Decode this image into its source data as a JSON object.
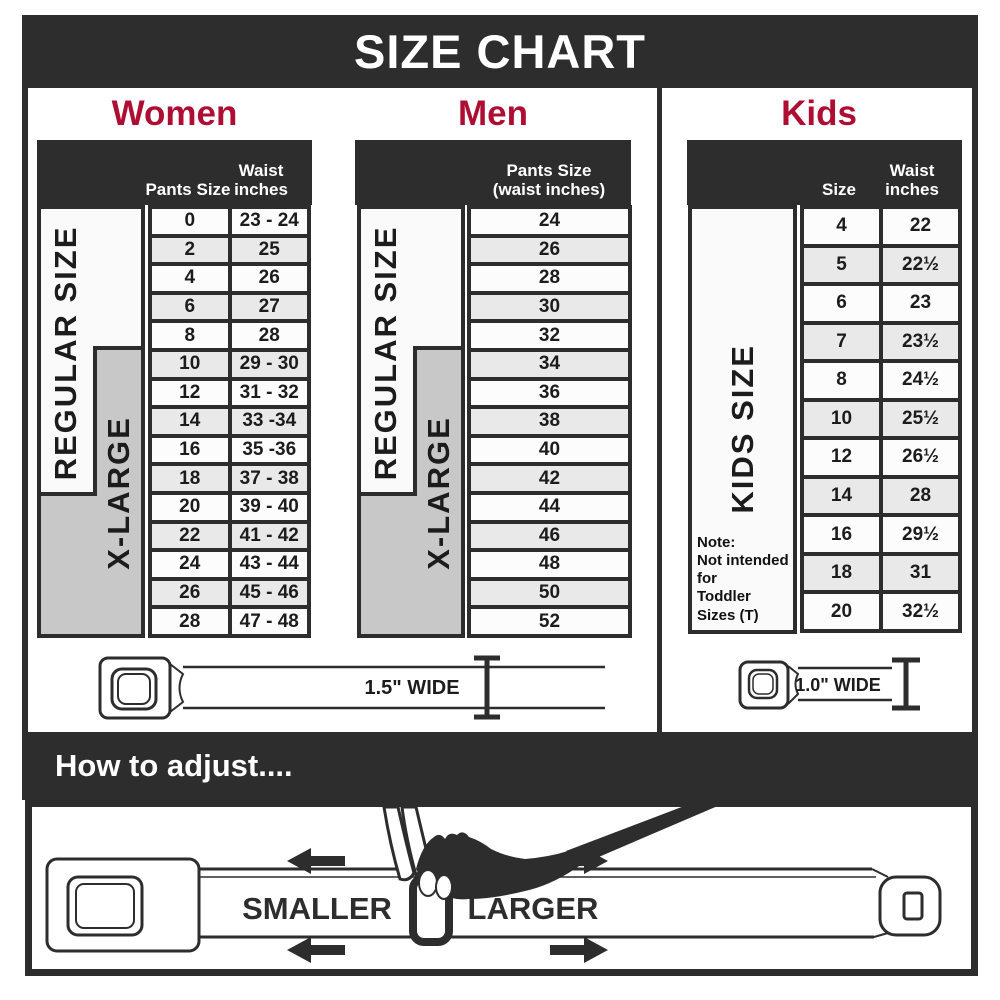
{
  "title": "SIZE CHART",
  "colors": {
    "header_dark": "#2d2d2d",
    "accent_red": "#ae0e33",
    "row_alt_gray": "#e9e9e9",
    "row_base": "#fcfcfc",
    "xlarge_gray": "#c8c8c8"
  },
  "chart_data": [
    {
      "type": "table",
      "title": "Women",
      "columns": [
        "Pants Size",
        "Waist inches"
      ],
      "region_labels": [
        "REGULAR SIZE",
        "X-LARGE"
      ],
      "rows": [
        [
          "0",
          "23 - 24"
        ],
        [
          "2",
          "25"
        ],
        [
          "4",
          "26"
        ],
        [
          "6",
          "27"
        ],
        [
          "8",
          "28"
        ],
        [
          "10",
          "29 - 30"
        ],
        [
          "12",
          "31 - 32"
        ],
        [
          "14",
          "33 -34"
        ],
        [
          "16",
          "35 -36"
        ],
        [
          "18",
          "37 - 38"
        ],
        [
          "20",
          "39 - 40"
        ],
        [
          "22",
          "41 - 42"
        ],
        [
          "24",
          "43 - 44"
        ],
        [
          "26",
          "45 - 46"
        ],
        [
          "28",
          "47 - 48"
        ]
      ]
    },
    {
      "type": "table",
      "title": "Men",
      "columns": [
        "Pants Size",
        "(waist inches)"
      ],
      "region_labels": [
        "REGULAR SIZE",
        "X-LARGE"
      ],
      "rows": [
        [
          "24"
        ],
        [
          "26"
        ],
        [
          "28"
        ],
        [
          "30"
        ],
        [
          "32"
        ],
        [
          "34"
        ],
        [
          "36"
        ],
        [
          "38"
        ],
        [
          "40"
        ],
        [
          "42"
        ],
        [
          "44"
        ],
        [
          "46"
        ],
        [
          "48"
        ],
        [
          "50"
        ],
        [
          "52"
        ]
      ]
    },
    {
      "type": "table",
      "title": "Kids",
      "columns": [
        "Size",
        "Waist inches"
      ],
      "region_labels": [
        "KIDS SIZE"
      ],
      "note": [
        "Note:",
        "Not intended for",
        "Toddler Sizes (T)"
      ],
      "rows": [
        [
          "4",
          "22"
        ],
        [
          "5",
          "22½"
        ],
        [
          "6",
          "23"
        ],
        [
          "7",
          "23½"
        ],
        [
          "8",
          "24½"
        ],
        [
          "10",
          "25½"
        ],
        [
          "12",
          "26½"
        ],
        [
          "14",
          "28"
        ],
        [
          "16",
          "29½"
        ],
        [
          "18",
          "31"
        ],
        [
          "20",
          "32½"
        ]
      ]
    }
  ],
  "belts": {
    "adult_width_label": "1.5\" WIDE",
    "kids_width_label": "1.0\" WIDE"
  },
  "adjust": {
    "heading": "How to adjust....",
    "smaller": "SMALLER",
    "larger": "LARGER"
  }
}
